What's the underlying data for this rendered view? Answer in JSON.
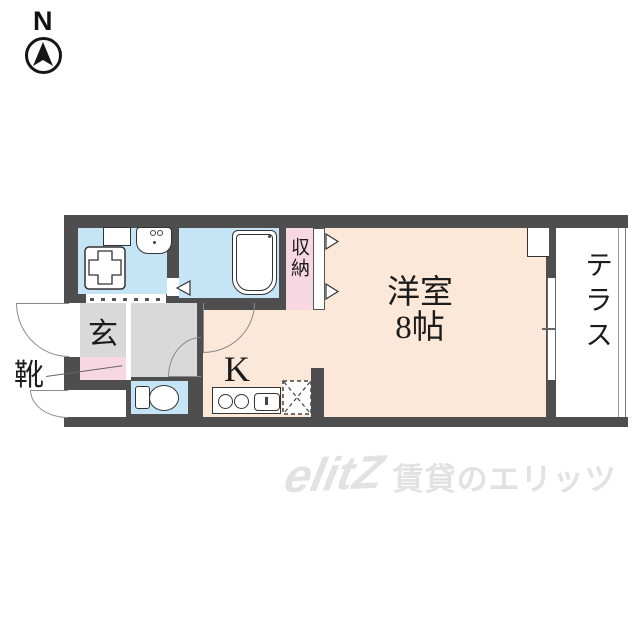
{
  "compass": {
    "label": "N"
  },
  "plan": {
    "entrance_label": "玄",
    "shoes_label": "靴",
    "kitchen_label": "K",
    "closet_label": "収納",
    "main_room_name": "洋室",
    "main_room_size": "8帖",
    "terrace_label": "テラス"
  },
  "watermark": {
    "logo": "elitZ",
    "text": "賃貸のエリッツ"
  },
  "colors": {
    "wall": "#4e4e4e",
    "water_blue": "#c5e5f6",
    "room_peach": "#fce8d8",
    "closet_pink": "#f7d7e2",
    "hall_gray": "#d9d9d9",
    "line": "#333333",
    "watermark_gray": "#e2e2e2"
  }
}
